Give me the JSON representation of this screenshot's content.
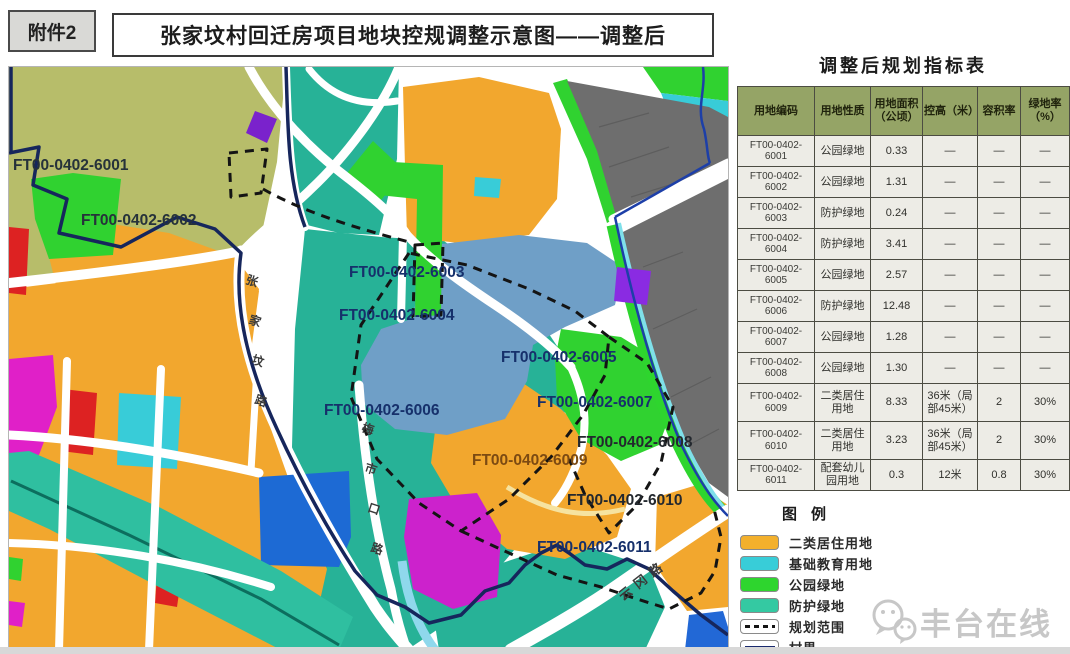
{
  "attachment": "附件2",
  "title": "张家坟村回迁房项目地块控规调整示意图——调整后",
  "panel": {
    "table_title": "调整后规划指标表",
    "headers": [
      "用地编码",
      "用地性质",
      "用地面积（公顷）",
      "控高（米）",
      "容积率",
      "绿地率（%）"
    ],
    "rows": [
      {
        "code1": "FT00-0402-",
        "code2": "6001",
        "nature": "公园绿地",
        "area": "0.33",
        "height": "—",
        "far": "—",
        "green": "—"
      },
      {
        "code1": "FT00-0402-",
        "code2": "6002",
        "nature": "公园绿地",
        "area": "1.31",
        "height": "—",
        "far": "—",
        "green": "—"
      },
      {
        "code1": "FT00-0402-",
        "code2": "6003",
        "nature": "防护绿地",
        "area": "0.24",
        "height": "—",
        "far": "—",
        "green": "—"
      },
      {
        "code1": "FT00-0402-",
        "code2": "6004",
        "nature": "防护绿地",
        "area": "3.41",
        "height": "—",
        "far": "—",
        "green": "—"
      },
      {
        "code1": "FT00-0402-",
        "code2": "6005",
        "nature": "公园绿地",
        "area": "2.57",
        "height": "—",
        "far": "—",
        "green": "—"
      },
      {
        "code1": "FT00-0402-",
        "code2": "6006",
        "nature": "防护绿地",
        "area": "12.48",
        "height": "—",
        "far": "—",
        "green": "—"
      },
      {
        "code1": "FT00-0402-",
        "code2": "6007",
        "nature": "公园绿地",
        "area": "1.28",
        "height": "—",
        "far": "—",
        "green": "—"
      },
      {
        "code1": "FT00-0402-",
        "code2": "6008",
        "nature": "公园绿地",
        "area": "1.30",
        "height": "—",
        "far": "—",
        "green": "—"
      },
      {
        "code1": "FT00-0402-",
        "code2": "6009",
        "nature": "二类居住用地",
        "area": "8.33",
        "height": "36米（局部45米）",
        "far": "2",
        "green": "30%",
        "tall": true
      },
      {
        "code1": "FT00-0402-",
        "code2": "6010",
        "nature": "二类居住用地",
        "area": "3.23",
        "height": "36米（局部45米）",
        "far": "2",
        "green": "30%",
        "tall": true
      },
      {
        "code1": "FT00-0402-",
        "code2": "6011",
        "nature": "配套幼儿园用地",
        "area": "0.3",
        "height": "12米",
        "far": "0.8",
        "green": "30%"
      }
    ]
  },
  "legend": {
    "title": "图例",
    "items": [
      {
        "label": "二类居住用地",
        "type": "fill",
        "color": "#f3b02c"
      },
      {
        "label": "基础教育用地",
        "type": "fill",
        "color": "#38cdd8"
      },
      {
        "label": "公园绿地",
        "type": "fill",
        "color": "#2ed52e"
      },
      {
        "label": "防护绿地",
        "type": "fill",
        "color": "#34c9a2"
      },
      {
        "label": "规划范围",
        "type": "dashed-line",
        "color": "#141414"
      },
      {
        "label": "村界",
        "type": "solid-line",
        "color": "#1a2a6e"
      }
    ]
  },
  "map": {
    "plot_labels": [
      {
        "text": "FT00-0402-6001",
        "x": 4,
        "y": 103,
        "color": "#26323a"
      },
      {
        "text": "FT00-0402-6002",
        "x": 72,
        "y": 158,
        "color": "#26323a"
      },
      {
        "text": "FT00-0402-6003",
        "x": 340,
        "y": 210,
        "color": "#16306b"
      },
      {
        "text": "FT00-0402-6004",
        "x": 330,
        "y": 253,
        "color": "#16306b"
      },
      {
        "text": "FT00-0402-6005",
        "x": 492,
        "y": 295,
        "color": "#16306b"
      },
      {
        "text": "FT00-0402-6006",
        "x": 315,
        "y": 348,
        "color": "#16306b"
      },
      {
        "text": "FT00-0402-6007",
        "x": 528,
        "y": 340,
        "color": "#16306b"
      },
      {
        "text": "FT00-0402-6008",
        "x": 568,
        "y": 380,
        "color": "#23282e"
      },
      {
        "text": "FT00-0402-6009",
        "x": 463,
        "y": 398,
        "color": "#7c4a12"
      },
      {
        "text": "FT00-0402-6010",
        "x": 558,
        "y": 438,
        "color": "#23282e"
      },
      {
        "text": "FT00-0402-6011",
        "x": 528,
        "y": 485,
        "color": "#16306b"
      }
    ],
    "road_labels": [
      {
        "text": "张家坟路",
        "x": 236,
        "y": 216,
        "mode": "vertical",
        "color": "#3a3a3a"
      },
      {
        "text": "梅市口路",
        "x": 352,
        "y": 364,
        "mode": "vertical",
        "color": "#3a3a3a"
      },
      {
        "text": "云冈路",
        "x": 614,
        "y": 534,
        "mode": "rotate",
        "angle": -38,
        "color": "#3a3a3a"
      }
    ]
  },
  "watermark": "丰台在线"
}
